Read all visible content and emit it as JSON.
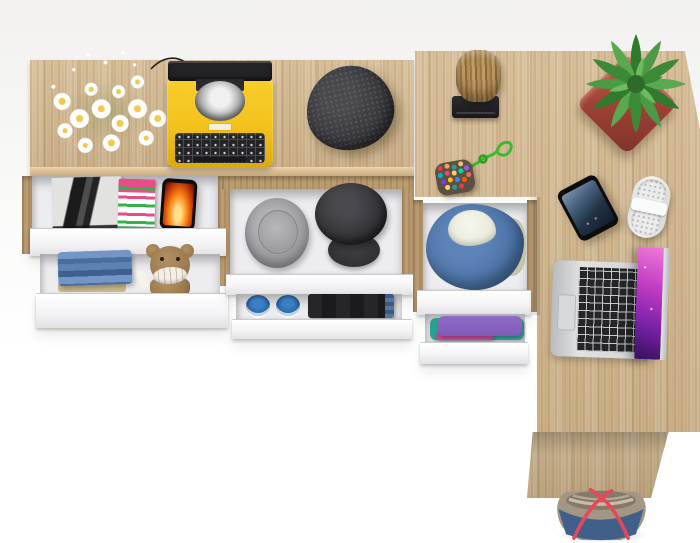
{
  "meta": {
    "description": "Top-down product photo of a light-oak L-shaped desk and sideboard with open white drawers filled with clothes, accessories and gadgets on a white background",
    "view": "top-down",
    "background_color": "#f7f6f5"
  },
  "palette": {
    "bg_top": "#f2f1ef",
    "wood": "#d2b68c",
    "wood_dark": "#bb9c70",
    "wood_edge": "#e6cda4",
    "drawer_face": "#f4f4f6",
    "drawer_box": "#ededf0",
    "typewriter_yellow": "#f3c21d",
    "platen_black": "#232325",
    "beanie_gray": "#2c2c30",
    "hat_gray": "#97979b",
    "cap_black": "#2b2a2f",
    "denim_blue": "#4d74a8",
    "fleece_white": "#e9eadb",
    "jeans_blue": "#5d81b3",
    "jeans_black": "#1b1b1e",
    "teddy_brown": "#9b7a50",
    "shoe_blue": "#2565a6",
    "shirt_purple": "#7e5bb8",
    "shirt_teal": "#2aa093",
    "stump_brown": "#a5804e",
    "pot_red": "#9c4034",
    "leaf_green": "#3f8f3a",
    "laptop_silver": "#cfd1d3",
    "screen_magenta": "#c23cc4",
    "phone_screen": "#233447",
    "charger_white": "#ececec",
    "bag_taupe": "#a39684",
    "bag_denim": "#40608a",
    "strap_red": "#e8475a",
    "flame_orange": "#ff8c1a",
    "magazine_pink": "#e84d8a",
    "magazine_green": "#35b04a",
    "daisy_yellow": "#f2c94c"
  },
  "furniture": {
    "console": {
      "label": "Oak sideboard top with open white drawers"
    },
    "desk": {
      "label": "L-shaped oak desk top"
    },
    "side_panel": {
      "label": "Desk side panel"
    },
    "drawers": {
      "magazines": {
        "label": "Open drawer with magazines and phone"
      },
      "jeans_teddy": {
        "label": "Open drawer with folded jeans and teddy bear"
      },
      "caps": {
        "label": "Open drawer with bucket hat and black cap"
      },
      "shoes": {
        "label": "Open drawer with blue sneakers and black jeans"
      },
      "hoodie": {
        "label": "Open drawer with denim hoodie"
      },
      "shirts": {
        "label": "Open drawer with purple and teal shirts"
      }
    }
  },
  "items": {
    "flowers": {
      "label": "Bouquet of white daisies",
      "color": "#ffffff"
    },
    "typewriter": {
      "label": "Yellow vintage typewriter",
      "color": "#f3c21d"
    },
    "beanie": {
      "label": "Dark gray knit beanie",
      "color": "#2c2c30"
    },
    "stump": {
      "label": "Wooden log on black stand",
      "color": "#a5804e"
    },
    "keychain": {
      "label": "Beaded pouch keychain with green cord",
      "color": "#3dbb2e"
    },
    "plant": {
      "label": "Green succulent in red square pot",
      "color": "#3f8f3a"
    },
    "phone_desk": {
      "label": "Smartphone on desk",
      "color": "#233447"
    },
    "charger": {
      "label": "White charger / power gadget",
      "color": "#ececec"
    },
    "laptop": {
      "label": "Silver laptop with purple galaxy wallpaper",
      "color": "#cfd1d3"
    },
    "bag": {
      "label": "Denim and taupe tote bag with red straps",
      "color": "#40608a"
    },
    "magazine_bw": {
      "label": "Black-and-white fashion magazine",
      "color": "#e2e2e0"
    },
    "magazine_color": {
      "label": "Pink and green magazine",
      "color": "#e84d8a"
    },
    "phone_flame": {
      "label": "Phone with orange flame wallpaper",
      "color": "#ff8c1a"
    },
    "jeans": {
      "label": "Stack of folded blue jeans",
      "color": "#5d81b3"
    },
    "teddy": {
      "label": "Brown teddy bear with white grin",
      "color": "#9b7a50"
    },
    "bucket_hat": {
      "label": "Gray bucket hat",
      "color": "#97979b"
    },
    "black_cap": {
      "label": "Black cap",
      "color": "#2b2a2f"
    },
    "sneakers": {
      "label": "Pair of blue sneakers",
      "color": "#2565a6"
    },
    "black_jeans": {
      "label": "Folded black jeans",
      "color": "#1b1b1e"
    },
    "hoodie": {
      "label": "Blue denim hoodie with fleece lining",
      "color": "#4d74a8"
    },
    "shirts": {
      "label": "Folded purple and teal shirts",
      "color": "#7e5bb8"
    }
  }
}
